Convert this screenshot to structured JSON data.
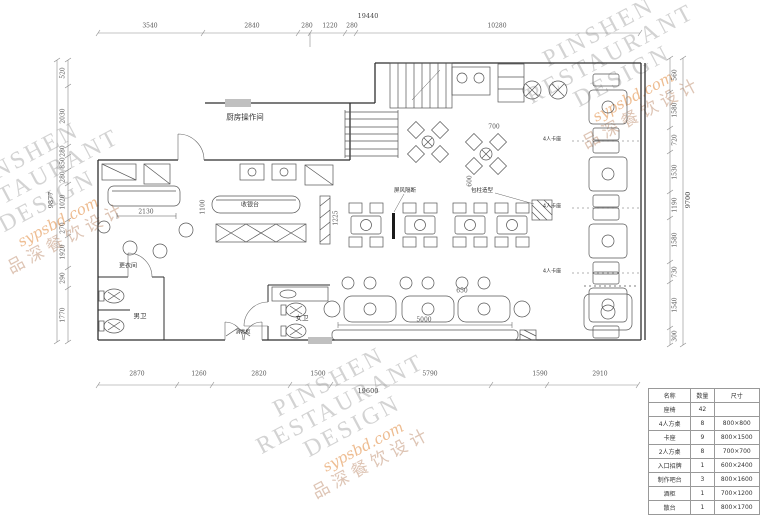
{
  "watermark": {
    "line1": "PINSHEN",
    "line2": "RESTAURANT",
    "line3": "DESIGN",
    "script": "sypsbd.com",
    "cn": "品深餐饮设计",
    "gray": "#d3d3d3",
    "accent": "#eebd92"
  },
  "dims": {
    "top": {
      "total": "19440",
      "segments": [
        "3540",
        "2840",
        "280",
        "1220",
        "280",
        "10280"
      ]
    },
    "bottom": {
      "total": "19600",
      "segments": [
        "2870",
        "1260",
        "2820",
        "1500",
        "5790",
        "1590",
        "2910"
      ]
    },
    "left": {
      "total": "9877",
      "segments": [
        "520",
        "2030",
        "280",
        "850",
        "280",
        "1020",
        "270",
        "1920",
        "290",
        "1770"
      ]
    },
    "right": {
      "total": "9700",
      "segments": [
        "560",
        "1580",
        "720",
        "1530",
        "1190",
        "1580",
        "730",
        "1540",
        "300"
      ]
    }
  },
  "rooms": {
    "kitchen": "厨房操作间",
    "men_wc": "男卫",
    "women_wc": "女卫",
    "dressing": "更衣间",
    "cashier": "收银台",
    "sterilizer": "消毒柜",
    "callout_left": "屏风隔断",
    "callout_right": "包柱造型",
    "booth": "4人卡座"
  },
  "plan_dims": [
    "2130",
    "1100",
    "1225",
    "5000",
    "650",
    "700",
    "600"
  ],
  "legend": {
    "headers": [
      "名称",
      "数量",
      "尺寸"
    ],
    "rows": [
      [
        "座椅",
        "42",
        ""
      ],
      [
        "4人方桌",
        "8",
        "800×800"
      ],
      [
        "卡座",
        "9",
        "800×1500"
      ],
      [
        "2人方桌",
        "8",
        "700×700"
      ],
      [
        "入口招牌",
        "1",
        "600×2400"
      ],
      [
        "制作吧台",
        "3",
        "800×1600"
      ],
      [
        "酒柜",
        "1",
        "700×1200"
      ],
      [
        "散台",
        "1",
        "800×1700"
      ]
    ]
  }
}
